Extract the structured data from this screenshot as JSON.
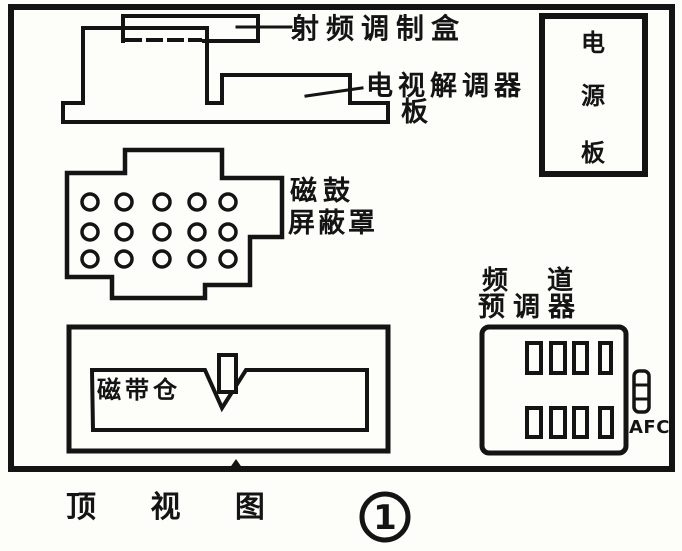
{
  "title": "顶 视 图",
  "figure_number": "1",
  "colors": {
    "ink": "#141414",
    "paper": "#fdfdfa"
  },
  "labels": {
    "rf_modulator": "射频调制盒",
    "tv_demodulator": {
      "line1": "电视解调器",
      "line2": "板"
    },
    "drum_shield": {
      "line1": "磁鼓",
      "line2": "屏蔽罩"
    },
    "power_board": {
      "char1": "电",
      "char2": "源",
      "char3": "板"
    },
    "channel_tuner": {
      "line1": "频 道",
      "line2": "预调器"
    },
    "afc": "AFC",
    "tape_compartment": "磁带仓"
  }
}
